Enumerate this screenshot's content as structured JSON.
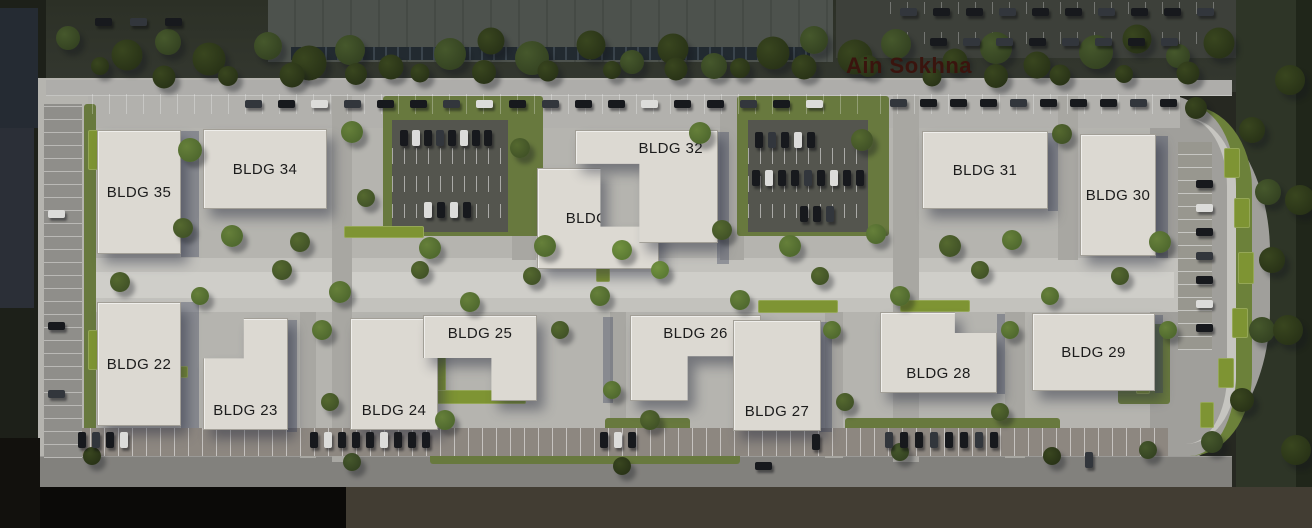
{
  "map": {
    "area_label": "Ain Sokhna",
    "buildings": [
      {
        "id": "BLDG-22",
        "label": "BLDG 22"
      },
      {
        "id": "BLDG-23",
        "label": "BLDG 23"
      },
      {
        "id": "BLDG-24",
        "label": "BLDG 24"
      },
      {
        "id": "BLDG-25",
        "label": "BLDG 25"
      },
      {
        "id": "BLDG-26",
        "label": "BLDG 26"
      },
      {
        "id": "BLDG-27",
        "label": "BLDG 27"
      },
      {
        "id": "BLDG-28",
        "label": "BLDG 28"
      },
      {
        "id": "BLDG-29",
        "label": "BLDG 29"
      },
      {
        "id": "BLDG-30",
        "label": "BLDG 30"
      },
      {
        "id": "BLDG-31",
        "label": "BLDG 31"
      },
      {
        "id": "BLDG-32",
        "label": "BLDG 32"
      },
      {
        "id": "BLDG-33",
        "label": "BLDG 33"
      },
      {
        "id": "BLDG-34",
        "label": "BLDG 34"
      },
      {
        "id": "BLDG-35",
        "label": "BLDG 35"
      }
    ],
    "colors": {
      "area_label_text": "#3a140e",
      "building_fill": "#dcd9d2",
      "building_label_text": "#1c1c1c",
      "grass": "#68793e",
      "hedge": "#7e9433",
      "hedge_dark": "#6c813a",
      "pavement": "#b5b4af",
      "asphalt": "#54554e"
    }
  }
}
